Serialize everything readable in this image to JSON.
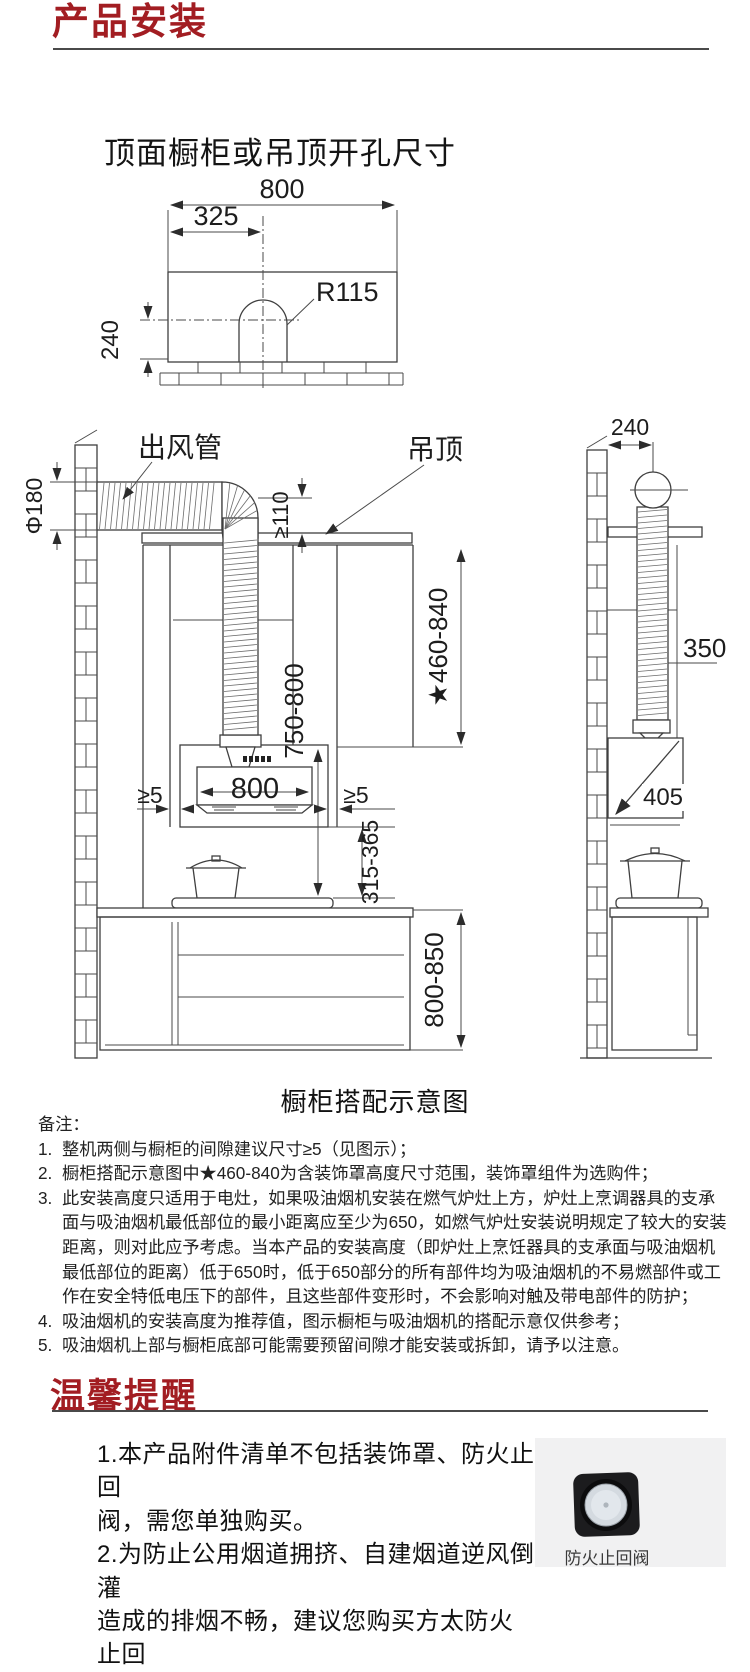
{
  "header": {
    "title": "产品安装"
  },
  "diagram1": {
    "title": "顶面橱柜或吊顶开孔尺寸",
    "dim_width": "800",
    "dim_offset": "325",
    "dim_radius": "R115",
    "dim_depth": "240"
  },
  "diagram2": {
    "caption": "橱柜搭配示意图",
    "label_duct": "出风管",
    "label_ceiling": "吊顶",
    "dim_duct_dia": "Φ180",
    "dim_ceiling_gap": "≥110",
    "dim_cover_range": "★460-840",
    "dim_hood_top": "750-800",
    "dim_hood_width": "800",
    "dim_side_gap": "≥5",
    "dim_hood_bottom": "315-365",
    "dim_counter": "800-850",
    "dim_wall_offset": "240",
    "dim_side_height": "350",
    "dim_side_width": "405"
  },
  "notes": {
    "label": "备注：",
    "items": [
      {
        "num": "1.",
        "text": "整机两侧与橱柜的间隙建议尺寸≥5（见图示）；"
      },
      {
        "num": "2.",
        "text": "橱柜搭配示意图中★460-840为含装饰罩高度尺寸范围，装饰罩组件为选购件；"
      },
      {
        "num": "3.",
        "text": "此安装高度只适用于电灶，如果吸油烟机安装在燃气炉灶上方，炉灶上烹调器具的支承面与吸油烟机最低部位的最小距离应至少为650，如燃气炉灶安装说明规定了较大的安装距离，则对此应予考虑。当本产品的安装高度（即炉灶上烹饪器具的支承面与吸油烟机最低部位的距离）低于650时，低于650部分的所有部件均为吸油烟机的不易燃部件或工作在安全特低电压下的部件，且这些部件变形时，不会影响对触及带电部件的防护；"
      },
      {
        "num": "4.",
        "text": "吸油烟机的安装高度为推荐值，图示橱柜与吸油烟机的搭配示意仅供参考；"
      },
      {
        "num": "5.",
        "text": "吸油烟机上部与橱柜底部可能需要预留间隙才能安装或拆卸，请予以注意。"
      }
    ]
  },
  "reminder": {
    "title": "温馨提醒",
    "lines": [
      "1.本产品附件清单不包括装饰罩、防火止回",
      "阀，需您单独购买。",
      "2.为防止公用烟道拥挤、自建烟道逆风倒灌",
      "造成的排烟不畅，建议您购买方太防火止回"
    ],
    "valve_label": "防火止回阀"
  }
}
